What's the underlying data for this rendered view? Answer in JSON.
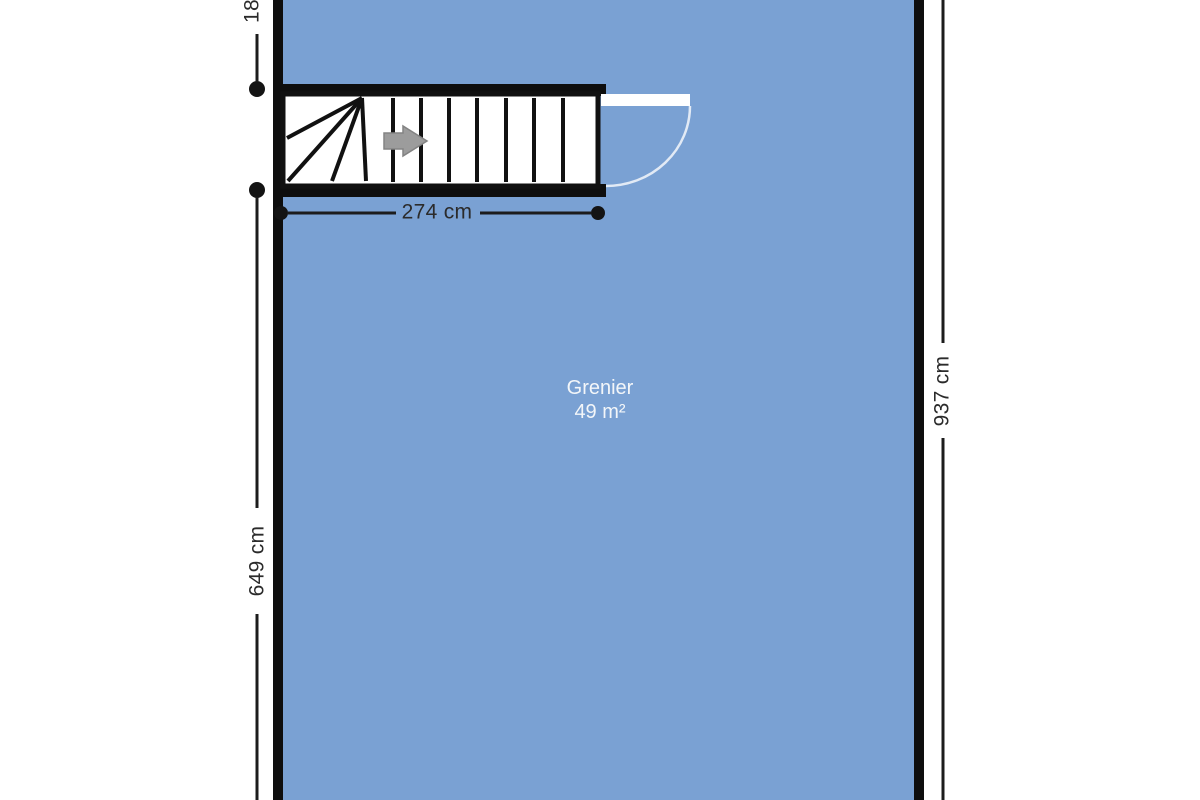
{
  "floorplan": {
    "room": {
      "name": "Grenier",
      "area": "49 m²"
    },
    "dimensions": {
      "stair_width": "274 cm",
      "right_height": "937 cm",
      "left_height": "649 cm",
      "top_left_partial": "18"
    },
    "colors": {
      "floor_fill": "#7aa1d3",
      "wall": "#0e0e0e",
      "stair_line": "#111111",
      "dimension_line": "#1c1c1c",
      "dimension_text": "#2b2b2b",
      "room_label_text": "#f3f6f9",
      "arrow_fill": "#9c9c9c",
      "door_leaf": "#ffffff"
    }
  }
}
